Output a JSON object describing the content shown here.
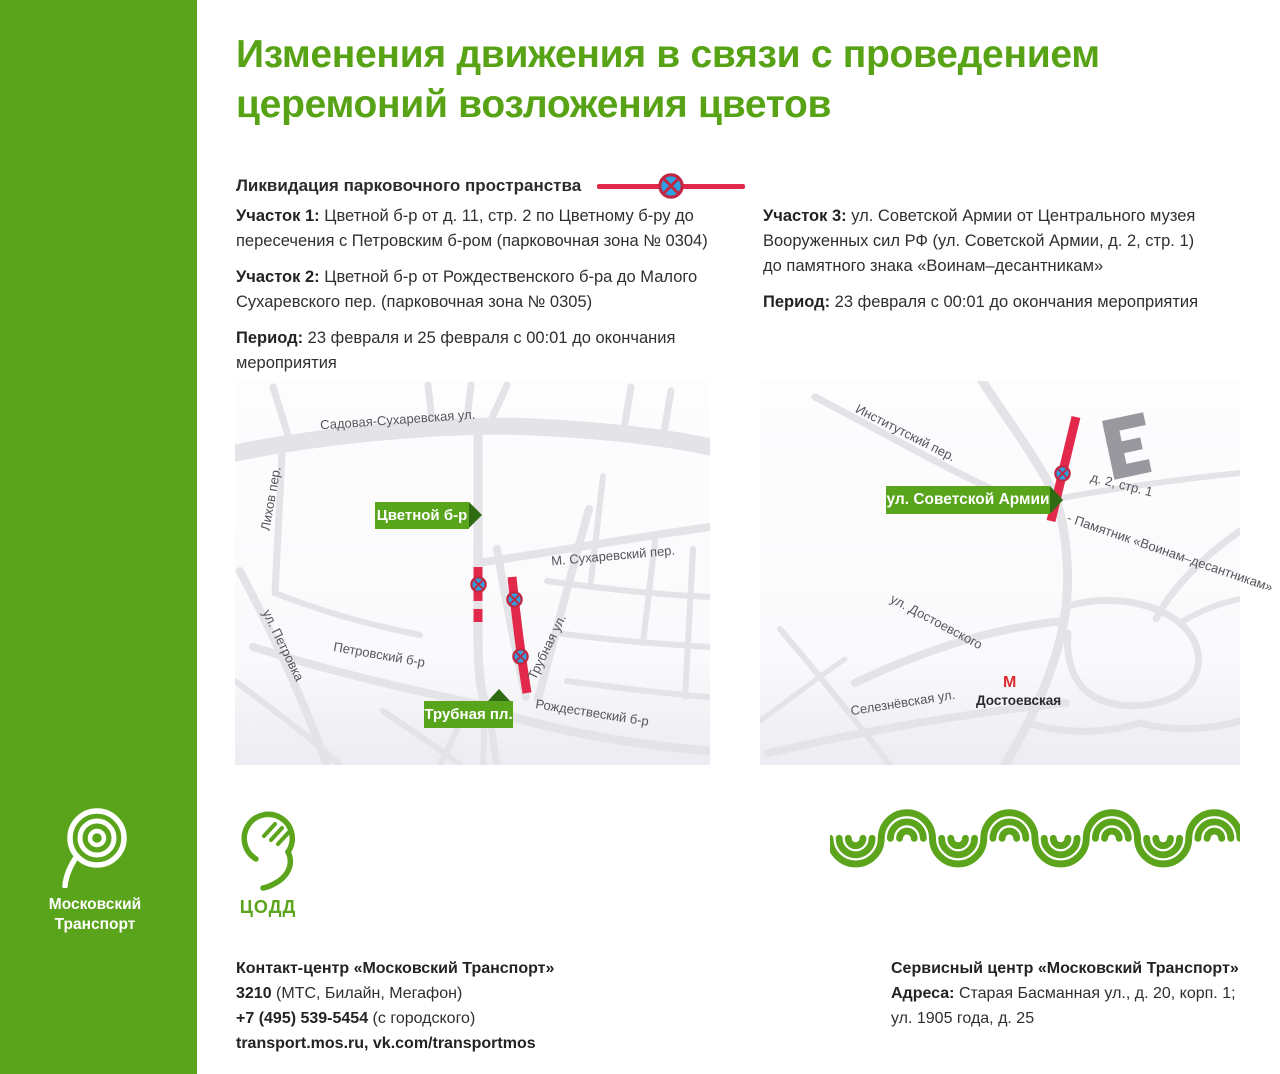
{
  "colors": {
    "green": "#5aa41b",
    "title_green": "#57a315",
    "tag_green": "#58a51c",
    "tag_arrow_green": "#2e6b13",
    "red": "#e2294b",
    "sign_blue": "#2e9fe0",
    "sign_border": "#c22742",
    "road_gray": "#e3e3e8",
    "building_gray": "#98989e",
    "metro_red": "#dd2b31"
  },
  "title": {
    "line1": "Изменения движения в связи с проведением",
    "line2": "церемоний возложения цветов"
  },
  "legend": {
    "label": "Ликвидация парковочного пространства",
    "icon": "no-stopping-sign"
  },
  "sections": {
    "s1": {
      "label": "Участок 1:",
      "text": " Цветной б-р от д. 11, стр. 2 по Цветному б-ру до пересечения с Петровским б-ром (парковочная зона № 0304)"
    },
    "s2": {
      "label": "Участок 2:",
      "text": " Цветной б-р от Рождественского б-ра до Малого Сухаревского пер. (парковочная зона № 0305)"
    },
    "period1": {
      "label": "Период:",
      "text": " 23 февраля и 25 февраля с 00:01 до окончания мероприятия"
    },
    "s3": {
      "label": "Участок 3:",
      "text": " ул. Советской Армии от Центрального музея Вооруженных сил РФ (ул. Советской Армии, д. 2, стр. 1) до памятного знака «Воинам–десантникам»"
    },
    "period2": {
      "label": "Период:",
      "text": " 23 февраля с 00:01 до окончания мероприятия"
    }
  },
  "map_left": {
    "tag1": "Цветной б-р",
    "tag2": "Трубная пл.",
    "streets": {
      "sadovaya": "Садовая-Сухаревская ул.",
      "lihov": "Лихов пер.",
      "msuhar": "М. Сухаревский пер.",
      "petrovka": "ул. Петровка",
      "petrovskiy": "Петровский б-р",
      "trubnaya": "Трубная ул.",
      "rozhdestvensky": "Рождествеский б-р"
    }
  },
  "map_right": {
    "tag": "ул. Советской Армии",
    "streets": {
      "institutsky": "Институтский пер.",
      "dostoevskogo": "ул. Достоевского",
      "seleznevskaya": "Селезнёвская ул."
    },
    "building": "д. 2, стр. 1",
    "monument": "- Памятник «Воинам–десантникам»",
    "metro_m": "М",
    "metro": "Достоевская"
  },
  "logos": {
    "mt_line1": "Московский",
    "mt_line2": "Транспорт",
    "codd": "ЦОДД"
  },
  "contacts_left": {
    "title": "Контакт-центр «Московский Транспорт»",
    "phone_short": "3210",
    "phone_short_rest": " (МТС, Билайн, Мегафон)",
    "phone_city": "+7 (495) 539-5454",
    "phone_city_rest": " (с городского)",
    "web": "transport.mos.ru, vk.com/transportmos"
  },
  "contacts_right": {
    "title": "Сервисный центр «Московский Транспорт»",
    "addr_label": "Адреса:",
    "addr_text": " Старая Басманная ул., д. 20, корп. 1;",
    "addr_line2": "ул. 1905 года, д. 25"
  }
}
